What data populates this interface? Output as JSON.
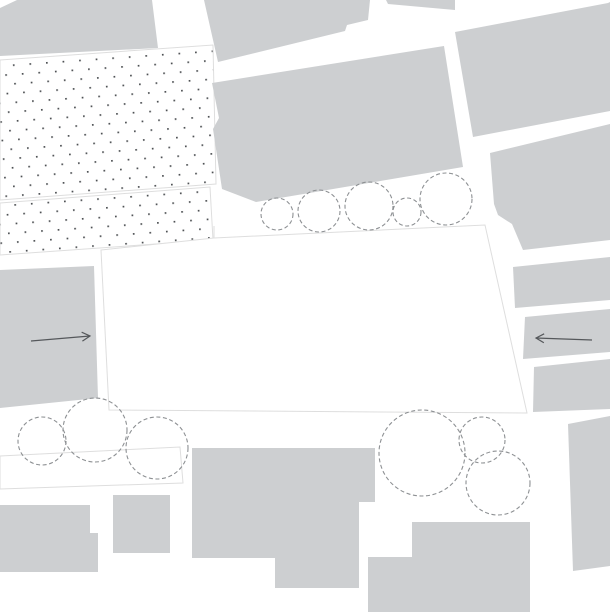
{
  "figure": {
    "kind": "architectural-site-plan",
    "description": "Figure-ground site plan: gray building blocks, white central plaza parcel, dotted paved areas, dashed tree canopies, two flow arrows"
  },
  "canvas": {
    "width": 610,
    "height": 612,
    "background": "#ffffff"
  },
  "colors": {
    "building": "#cdcfd1",
    "outline": "#dedede",
    "dot": "#4e5154",
    "dash": "#8d9093",
    "arrow": "#55585b",
    "surface": "#ffffff"
  },
  "dot_grid": {
    "spacing_x": 16.6,
    "spacing_y": 18.6,
    "dot_size": 1.7,
    "angle": -4,
    "offset_x": 8.3,
    "offset_y": 9.3
  },
  "tree_style": {
    "dash": "4 2.6",
    "stroke_width": 1.1
  },
  "arrow_style": {
    "stroke_width": 1.2,
    "head_length": 8,
    "head_width": 4.5
  },
  "shapes": [
    {
      "name": "dotted-area-upper",
      "kind": "dotted",
      "points": "0,60 213,45 216,184 0,200"
    },
    {
      "name": "dotted-area-lower",
      "kind": "dotted",
      "points": "0,203 210,187 213,240 0,255"
    },
    {
      "name": "building-top-left",
      "kind": "building",
      "points": "0,8 17,0 152,0 158,48 0,56"
    },
    {
      "name": "building-top-mid",
      "kind": "building",
      "points": "204,0 370,0 368,20 347,25 345,31 218,62"
    },
    {
      "name": "building-top-sliver",
      "kind": "building",
      "points": "386,0 455,0 455,10 388,4"
    },
    {
      "name": "building-center-north",
      "kind": "building",
      "points": "212,83 444,46 463,167 256,202 222,189 213,129 219,118"
    },
    {
      "name": "building-top-right",
      "kind": "building",
      "points": "455,32 608,3 610,2 610,111 473,137"
    },
    {
      "name": "building-right-upper",
      "kind": "building",
      "points": "490,153 610,124 610,240 523,250 512,224 498,215 494,204"
    },
    {
      "name": "building-right-strip-1",
      "kind": "building",
      "points": "513,267 610,257 610,300 515,308"
    },
    {
      "name": "building-right-strip-2",
      "kind": "building",
      "points": "525,317 610,309 610,352 523,359"
    },
    {
      "name": "building-right-strip-3",
      "kind": "building",
      "points": "534,367 610,359 610,409 533,412"
    },
    {
      "name": "building-right-tower",
      "kind": "building",
      "points": "568,424 610,416 610,566 573,571"
    },
    {
      "name": "building-left-mid",
      "kind": "building",
      "points": "0,270 94,266 98,398 0,408"
    },
    {
      "name": "building-bottom-left-l",
      "kind": "building",
      "points": "0,505 90,505 90,533 98,533 98,572 0,572"
    },
    {
      "name": "building-bottom-square",
      "kind": "building",
      "points": "113,495 170,495 170,553 113,553"
    },
    {
      "name": "building-bottom-center",
      "kind": "building",
      "points": "192,448 375,448 375,502 359,502 359,588 275,588 275,558 192,558"
    },
    {
      "name": "building-bottom-right-l",
      "kind": "building",
      "points": "412,522 530,522 530,612 368,612 368,557 412,557"
    },
    {
      "name": "central-plaza-parcel",
      "kind": "surface",
      "points": "101,250 214,238 485,225 527,413 109,410"
    },
    {
      "name": "walkway-strip",
      "kind": "surface",
      "points": "0,456 180,447 183,483 0,489"
    },
    {
      "name": "plaza-edge-detail-line",
      "kind": "detail-line",
      "x1": 214,
      "y1": 226,
      "x2": 214,
      "y2": 238
    },
    {
      "name": "tree-canopy-top-1",
      "kind": "tree",
      "cx": 277,
      "cy": 214,
      "r": 16
    },
    {
      "name": "tree-canopy-top-2",
      "kind": "tree",
      "cx": 319,
      "cy": 211,
      "r": 21
    },
    {
      "name": "tree-canopy-top-3",
      "kind": "tree",
      "cx": 369,
      "cy": 206,
      "r": 24
    },
    {
      "name": "tree-canopy-top-4",
      "kind": "tree",
      "cx": 407,
      "cy": 212,
      "r": 14
    },
    {
      "name": "tree-canopy-top-5",
      "kind": "tree",
      "cx": 446,
      "cy": 199,
      "r": 26
    },
    {
      "name": "tree-canopy-southwest-1",
      "kind": "tree",
      "cx": 42,
      "cy": 441,
      "r": 24
    },
    {
      "name": "tree-canopy-southwest-2",
      "kind": "tree",
      "cx": 95,
      "cy": 430,
      "r": 32
    },
    {
      "name": "tree-canopy-southwest-3",
      "kind": "tree",
      "cx": 157,
      "cy": 448,
      "r": 31
    },
    {
      "name": "tree-canopy-southeast-1",
      "kind": "tree",
      "cx": 422,
      "cy": 453,
      "r": 43
    },
    {
      "name": "tree-canopy-southeast-2",
      "kind": "tree",
      "cx": 482,
      "cy": 440,
      "r": 23
    },
    {
      "name": "tree-canopy-southeast-3",
      "kind": "tree",
      "cx": 498,
      "cy": 483,
      "r": 32
    },
    {
      "name": "flow-arrow-east",
      "kind": "arrow",
      "x1": 31,
      "y1": 341,
      "x2": 90,
      "y2": 336
    },
    {
      "name": "flow-arrow-west",
      "kind": "arrow",
      "x1": 592,
      "y1": 340,
      "x2": 536,
      "y2": 338
    }
  ]
}
